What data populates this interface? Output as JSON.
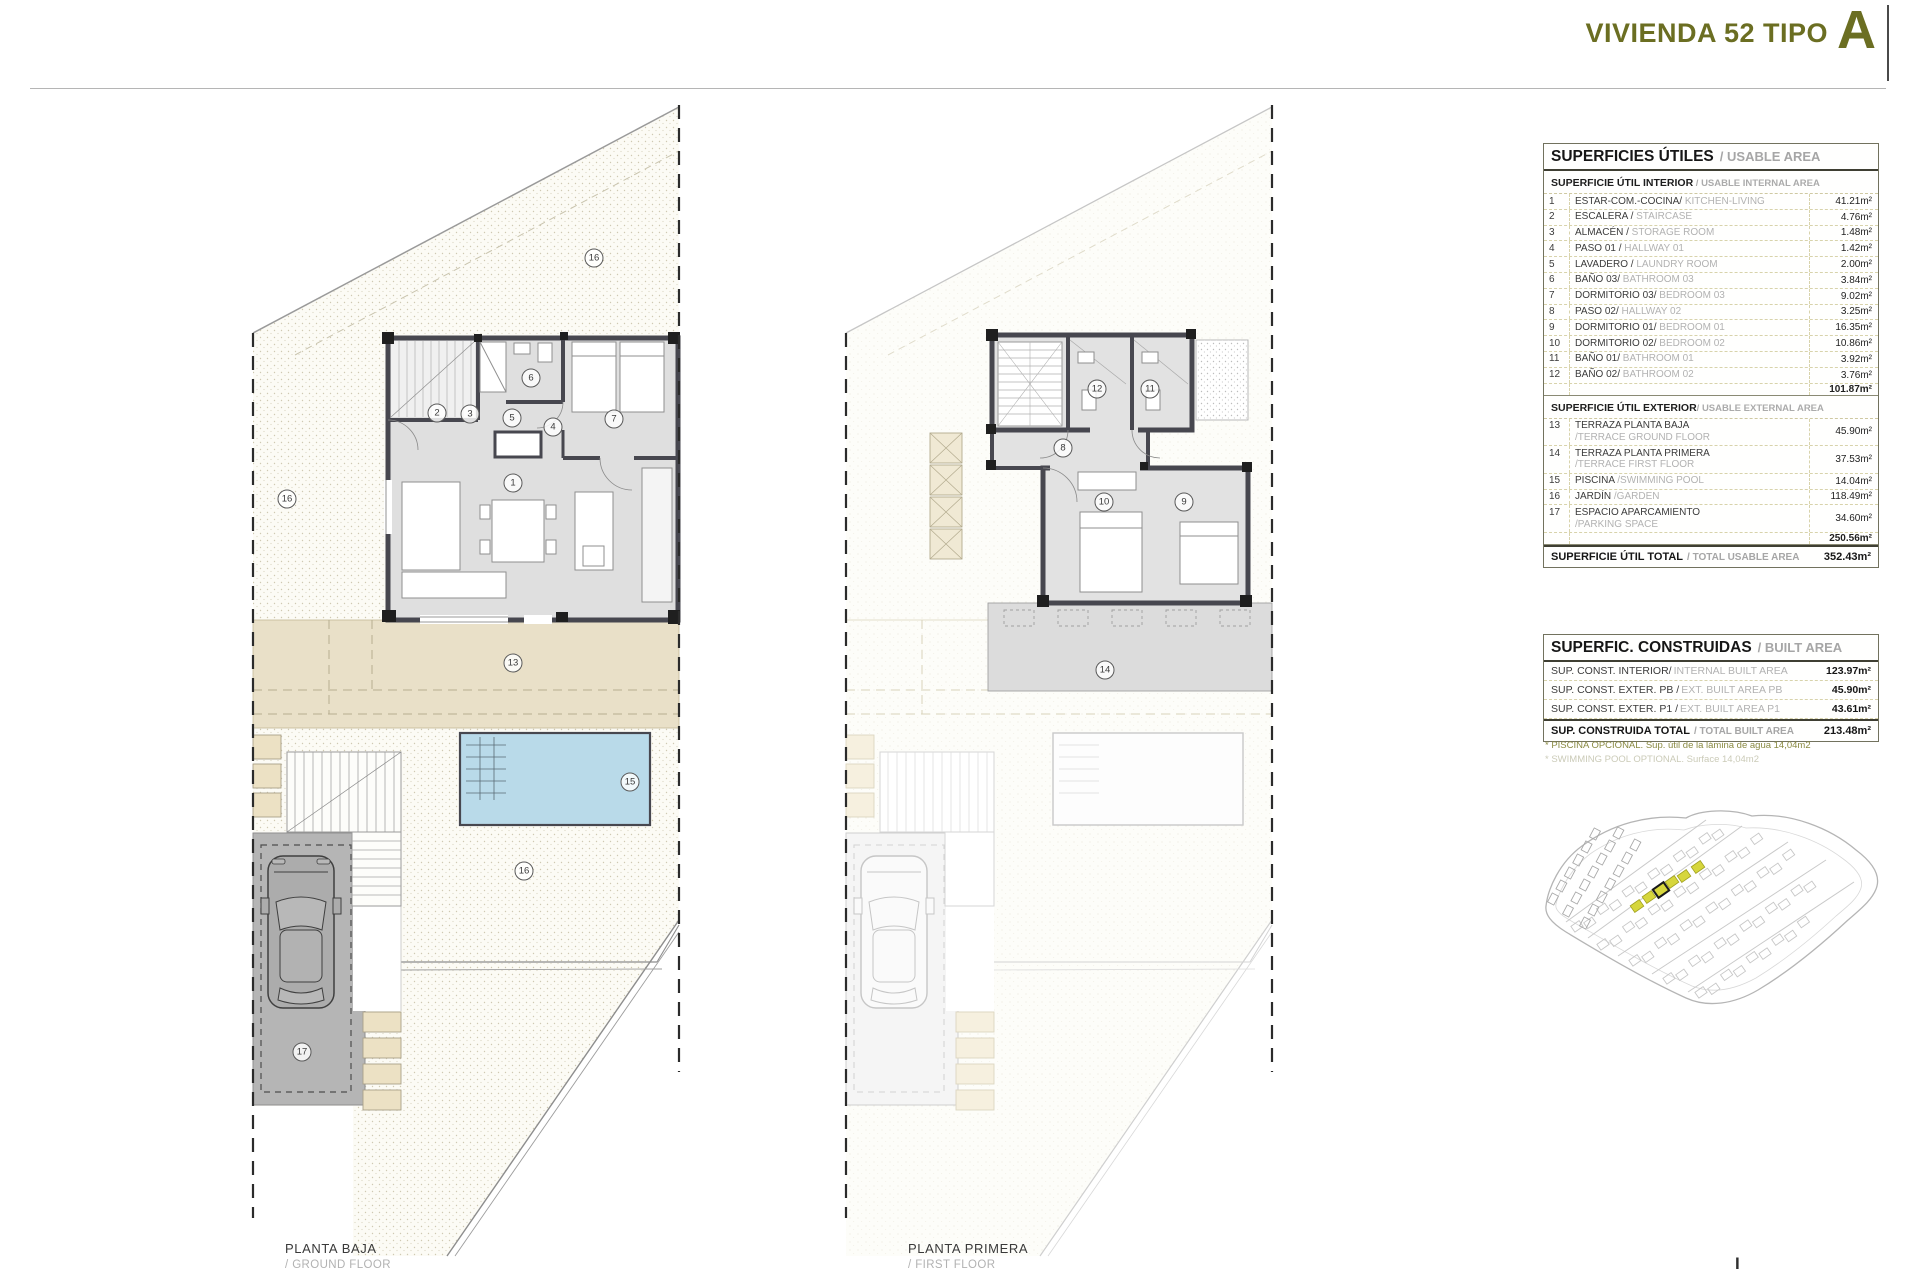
{
  "title": {
    "main": "VIVIENDA 52 TIPO",
    "letter": "A"
  },
  "colors": {
    "accent_olive": "#6b6e22",
    "terrace_beige": "#e9e0c8",
    "pool_blue": "#b9dae9",
    "garage_gray": "#b5b5b5",
    "wall_dark": "#47474f",
    "site_highlight": "#d6d63c"
  },
  "plans": [
    {
      "label": "PLANTA BAJA",
      "sublabel": "/ GROUND FLOOR",
      "markers": [
        {
          "n": "16",
          "x": 594,
          "y": 258
        },
        {
          "n": "16",
          "x": 287,
          "y": 499
        },
        {
          "n": "2",
          "x": 437,
          "y": 413
        },
        {
          "n": "3",
          "x": 470,
          "y": 414
        },
        {
          "n": "5",
          "x": 512,
          "y": 418
        },
        {
          "n": "6",
          "x": 531,
          "y": 378
        },
        {
          "n": "4",
          "x": 553,
          "y": 427
        },
        {
          "n": "7",
          "x": 614,
          "y": 419
        },
        {
          "n": "1",
          "x": 513,
          "y": 483
        },
        {
          "n": "13",
          "x": 513,
          "y": 663
        },
        {
          "n": "15",
          "x": 630,
          "y": 782
        },
        {
          "n": "16",
          "x": 524,
          "y": 871
        },
        {
          "n": "17",
          "x": 302,
          "y": 1052
        }
      ]
    },
    {
      "label": "PLANTA PRIMERA",
      "sublabel": "/ FIRST FLOOR",
      "markers": [
        {
          "n": "12",
          "x": 1097,
          "y": 389
        },
        {
          "n": "11",
          "x": 1150,
          "y": 389
        },
        {
          "n": "8",
          "x": 1063,
          "y": 448
        },
        {
          "n": "10",
          "x": 1104,
          "y": 502
        },
        {
          "n": "9",
          "x": 1184,
          "y": 502
        },
        {
          "n": "14",
          "x": 1105,
          "y": 670
        }
      ]
    }
  ],
  "usable_table": {
    "title_es": "SUPERFICIES ÚTILES",
    "title_en": "/ USABLE AREA",
    "interior_header_es": "SUPERFICIE ÚTIL INTERIOR",
    "interior_header_en": " / USABLE INTERNAL AREA",
    "interior_rows": [
      {
        "num": "1",
        "es": "ESTAR-COM.-COCINA/",
        "en": "KITCHEN-LIVING",
        "value": "41.21m²"
      },
      {
        "num": "2",
        "es": "ESCALERA /",
        "en": "STAIRCASE",
        "value": "4.76m²"
      },
      {
        "num": "3",
        "es": "ALMACÉN  /",
        "en": "STORAGE ROOM",
        "value": "1.48m²"
      },
      {
        "num": "4",
        "es": "PASO 01 /",
        "en": "HALLWAY  01",
        "value": "1.42m²"
      },
      {
        "num": "5",
        "es": "LAVADERO /",
        "en": "LAUNDRY ROOM",
        "value": "2.00m²"
      },
      {
        "num": "6",
        "es": "BAÑO 03/",
        "en": "BATHROOM 03",
        "value": "3.84m²"
      },
      {
        "num": "7",
        "es": "DORMITORIO 03/",
        "en": "BEDROOM 03",
        "value": "9.02m²"
      },
      {
        "num": "8",
        "es": "PASO 02/",
        "en": "HALLWAY 02",
        "value": "3.25m²"
      },
      {
        "num": "9",
        "es": "DORMITORIO 01/",
        "en": "BEDROOM 01",
        "value": "16.35m²"
      },
      {
        "num": "10",
        "es": "DORMITORIO 02/",
        "en": "BEDROOM 02",
        "value": "10.86m²"
      },
      {
        "num": "11",
        "es": "BAÑO 01/",
        "en": "BATHROOM 01",
        "value": "3.92m²"
      },
      {
        "num": "12",
        "es": "BAÑO 02/",
        "en": "BATHROOM 02",
        "value": "3.76m²"
      }
    ],
    "interior_subtotal": "101.87m²",
    "exterior_header_es": "SUPERFICIE ÚTIL EXTERIOR",
    "exterior_header_en": "/ USABLE EXTERNAL AREA",
    "exterior_rows": [
      {
        "num": "13",
        "es": "TERRAZA PLANTA BAJA",
        "line2": "/TERRACE GROUND FLOOR",
        "value": "45.90m²"
      },
      {
        "num": "14",
        "es": "TERRAZA PLANTA PRIMERA",
        "line2": "/TERRACE FIRST FLOOR",
        "value": "37.53m²"
      },
      {
        "num": "15",
        "es": "PISCINA",
        "en": "/SWIMMING POOL",
        "value": "14.04m²"
      },
      {
        "num": "16",
        "es": "JARDÍN",
        "en": "/GARDEN",
        "value": "118.49m²"
      },
      {
        "num": "17",
        "es": "ESPACIO APARCAMIENTO",
        "line2": "/PARKING SPACE",
        "value": "34.60m²"
      }
    ],
    "exterior_subtotal": "250.56m²",
    "total_label_es": "SUPERFICIE ÚTIL TOTAL",
    "total_label_en": "/ TOTAL USABLE AREA",
    "total_value": "352.43m²"
  },
  "built_table": {
    "title_es": "SUPERFIC. CONSTRUIDAS",
    "title_en": "/ BUILT AREA",
    "rows": [
      {
        "es": "SUP. CONST. INTERIOR/",
        "en": "INTERNAL BUILT AREA",
        "value": "123.97m²"
      },
      {
        "es": "SUP. CONST. EXTER. PB /",
        "en": "EXT. BUILT AREA PB",
        "value": "45.90m²"
      },
      {
        "es": "SUP. CONST. EXTER. P1 /",
        "en": "EXT. BUILT AREA P1",
        "value": "43.61m²"
      }
    ],
    "total_label_es": "SUP. CONSTRUIDA TOTAL",
    "total_label_en": "/ TOTAL BUILT AREA",
    "total_value": "213.48m²",
    "footnote_1": "* PISCINA OPCIONAL. Sup. útil de la lámina de agua 14,04m2",
    "footnote_2": "* SWIMMING POOL OPTIONAL. Surface 14,04m2"
  },
  "page_mark": "I"
}
